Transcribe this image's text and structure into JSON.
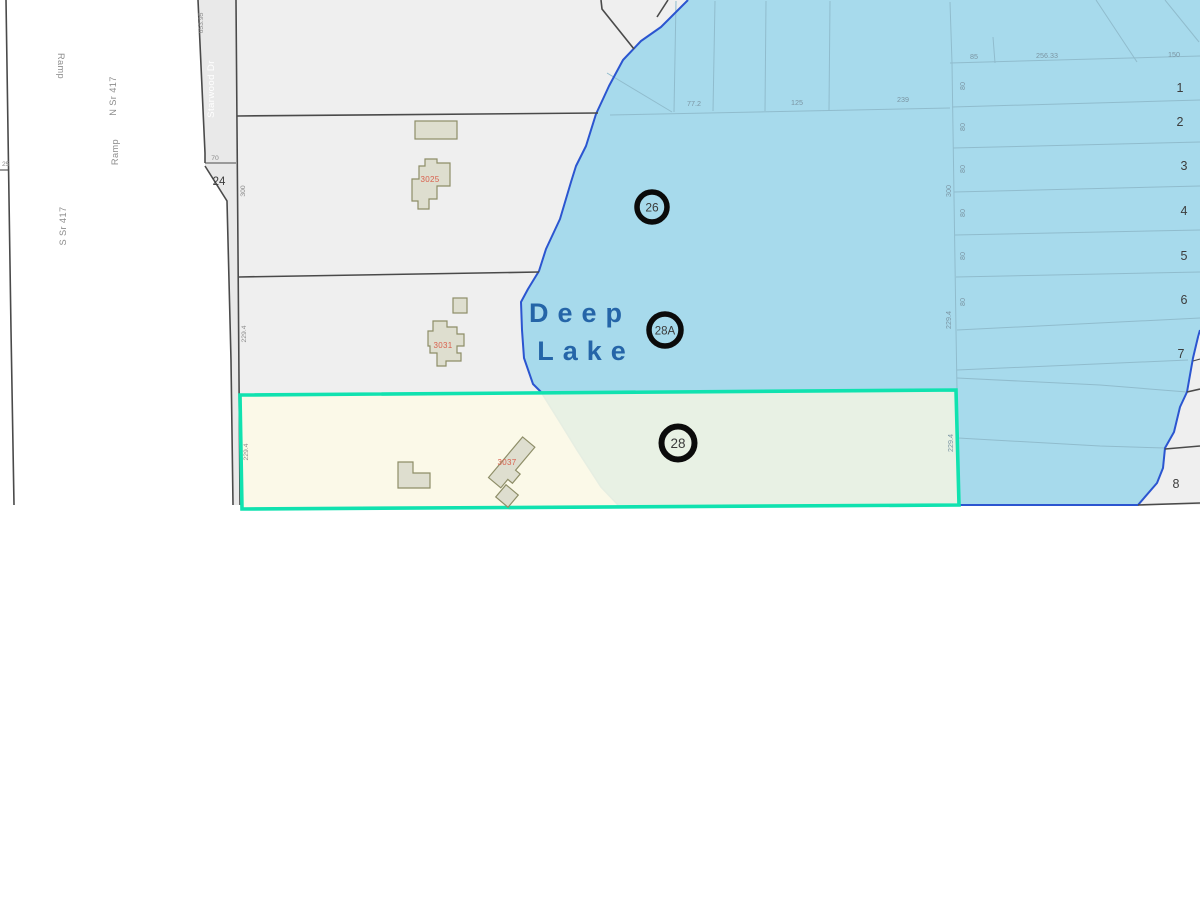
{
  "colors": {
    "lake-fill": "#a7daec",
    "lake-border": "#2b55d0",
    "lake-inner-line": "#90bccd",
    "parcel-fill": "#efefef",
    "road-fill": "#e9e9e9",
    "parcel-line": "#4a4a4a",
    "highlight-stroke": "#10e2af",
    "highlight-fill": "rgba(250,247,226,0.78)",
    "building-fill": "#dedecf",
    "building-stroke": "#8e8e68",
    "address-color": "#d9604d",
    "lake-label-color": "#2565a8",
    "dim-color": "#8a8a8a",
    "dim-lake-color": "#7b95a3",
    "lot-number-color": "#3c3c3c",
    "street-label-color": "#8c8c8c"
  },
  "lake": {
    "name_line1": "Deep",
    "name_line2": "Lake"
  },
  "markers": [
    {
      "label": "26"
    },
    {
      "label": "28A"
    },
    {
      "label": "28"
    }
  ],
  "lots": {
    "numbers": [
      "1",
      "2",
      "3",
      "4",
      "5",
      "6",
      "7",
      "8"
    ]
  },
  "streets": {
    "ramp_top": "Ramp",
    "n_sr_417": "N Sr 417",
    "ramp_mid": "Ramp",
    "s_sr_417": "S Sr 417",
    "starwood": "Starwood Dr"
  },
  "addresses": [
    "3025",
    "3031",
    "3037"
  ],
  "dimensions": {
    "starwood_top": "653.95",
    "left_25": "25",
    "seventy": "70",
    "corner_24": "24",
    "west_300": "300",
    "west_229a": "229.4",
    "west_229b": "229.4",
    "lake_77": "77.2",
    "lake_125": "125",
    "lake_239": "239",
    "top_85": "85",
    "top_256": "256.33",
    "top_150": "150",
    "east_300": "300",
    "east_229a": "229.4",
    "east_229b": "229.4",
    "lot_width": "80"
  }
}
